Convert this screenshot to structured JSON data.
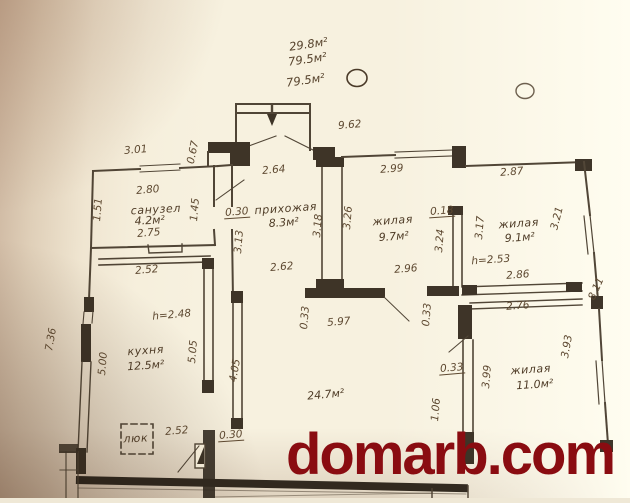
{
  "watermark": {
    "text": "domarb.com",
    "color": "#8a0c11"
  },
  "plan": {
    "ink": "#3f3324",
    "top_notes": [
      "29.8м²",
      "79.5м²",
      "79.5м²"
    ],
    "rooms": [
      {
        "name": "санузел",
        "area": "4.2м²",
        "height": ""
      },
      {
        "name": "прихожая",
        "area": "8.3м²",
        "height": ""
      },
      {
        "name": "жилая",
        "area": "9.7м²",
        "height": ""
      },
      {
        "name": "жилая",
        "area": "9.1м²",
        "height": "h=2.53"
      },
      {
        "name": "кухня",
        "area": "12.5м²",
        "height": "h=2.48"
      },
      {
        "name": "жилая",
        "area": "11.0м²",
        "height": ""
      },
      {
        "name": "люк",
        "area": "24.7м²",
        "height": ""
      }
    ],
    "labels": [
      {
        "t": "29.8м²",
        "x": 309,
        "y": 48,
        "r": -8,
        "c": "note"
      },
      {
        "t": "79.5м²",
        "x": 308,
        "y": 63,
        "r": -8,
        "c": "note"
      },
      {
        "t": "79.5м²",
        "x": 306,
        "y": 84,
        "r": -8,
        "c": "note"
      },
      {
        "t": "9.62",
        "x": 350,
        "y": 128,
        "r": -5,
        "c": "dim"
      },
      {
        "t": "3.01",
        "x": 136,
        "y": 153,
        "r": -5,
        "c": "dim"
      },
      {
        "t": "0.67",
        "x": 196,
        "y": 153,
        "r": -78,
        "c": "dim"
      },
      {
        "t": "2.80",
        "x": 148,
        "y": 193,
        "r": -5,
        "c": "dim"
      },
      {
        "t": "санузел",
        "x": 156,
        "y": 213,
        "r": -3,
        "c": "room"
      },
      {
        "t": "4.2м²",
        "x": 150,
        "y": 224,
        "r": -3,
        "c": "area"
      },
      {
        "t": "2.75",
        "x": 149,
        "y": 236,
        "r": -5,
        "c": "dim"
      },
      {
        "t": "1.51",
        "x": 101,
        "y": 210,
        "r": -85,
        "c": "dim"
      },
      {
        "t": "1.45",
        "x": 198,
        "y": 210,
        "r": -85,
        "c": "dim"
      },
      {
        "t": "0.30",
        "x": 237,
        "y": 215,
        "r": -4,
        "c": "dimu"
      },
      {
        "t": "2.64",
        "x": 274,
        "y": 173,
        "r": -5,
        "c": "dim"
      },
      {
        "t": "прихожая",
        "x": 286,
        "y": 212,
        "r": -4,
        "c": "room"
      },
      {
        "t": "8.3м²",
        "x": 284,
        "y": 226,
        "r": -4,
        "c": "area"
      },
      {
        "t": "3.13",
        "x": 242,
        "y": 242,
        "r": -85,
        "c": "dim"
      },
      {
        "t": "3.18",
        "x": 321,
        "y": 226,
        "r": -85,
        "c": "dim"
      },
      {
        "t": "2.62",
        "x": 282,
        "y": 270,
        "r": -5,
        "c": "dim"
      },
      {
        "t": "2.99",
        "x": 392,
        "y": 172,
        "r": -4,
        "c": "dim"
      },
      {
        "t": "3.26",
        "x": 351,
        "y": 218,
        "r": -85,
        "c": "dim"
      },
      {
        "t": "жилая",
        "x": 393,
        "y": 224,
        "r": -4,
        "c": "room"
      },
      {
        "t": "9.7м²",
        "x": 394,
        "y": 240,
        "r": -4,
        "c": "area"
      },
      {
        "t": "0.18",
        "x": 442,
        "y": 214,
        "r": -4,
        "c": "dimu"
      },
      {
        "t": "3.24",
        "x": 443,
        "y": 241,
        "r": -85,
        "c": "dim"
      },
      {
        "t": "2.96",
        "x": 406,
        "y": 272,
        "r": -4,
        "c": "dim"
      },
      {
        "t": "3.17",
        "x": 483,
        "y": 228,
        "r": -85,
        "c": "dim"
      },
      {
        "t": "2.87",
        "x": 512,
        "y": 175,
        "r": -4,
        "c": "dim"
      },
      {
        "t": "жилая",
        "x": 519,
        "y": 227,
        "r": -4,
        "c": "room"
      },
      {
        "t": "9.1м²",
        "x": 520,
        "y": 241,
        "r": -4,
        "c": "area"
      },
      {
        "t": "3.21",
        "x": 560,
        "y": 219,
        "r": -76,
        "c": "dim"
      },
      {
        "t": "h=2.53",
        "x": 491,
        "y": 263,
        "r": -4,
        "c": "dim"
      },
      {
        "t": "2.86",
        "x": 518,
        "y": 278,
        "r": -4,
        "c": "dim"
      },
      {
        "t": "8.11",
        "x": 599,
        "y": 290,
        "r": -66,
        "c": "dim"
      },
      {
        "t": "2.76",
        "x": 518,
        "y": 309,
        "r": -4,
        "c": "dim"
      },
      {
        "t": "0.33",
        "x": 308,
        "y": 318,
        "r": -85,
        "c": "dim"
      },
      {
        "t": "0.33",
        "x": 430,
        "y": 315,
        "r": -85,
        "c": "dim"
      },
      {
        "t": "5.97",
        "x": 339,
        "y": 325,
        "r": -4,
        "c": "dim"
      },
      {
        "t": "24.7м²",
        "x": 326,
        "y": 398,
        "r": -5,
        "c": "area"
      },
      {
        "t": "0.33",
        "x": 452,
        "y": 371,
        "r": -5,
        "c": "dimu"
      },
      {
        "t": "3.99",
        "x": 490,
        "y": 377,
        "r": -85,
        "c": "dim"
      },
      {
        "t": "жилая",
        "x": 531,
        "y": 373,
        "r": -4,
        "c": "room"
      },
      {
        "t": "11.0м²",
        "x": 535,
        "y": 388,
        "r": -4,
        "c": "area"
      },
      {
        "t": "3.93",
        "x": 570,
        "y": 347,
        "r": -80,
        "c": "dim"
      },
      {
        "t": "1.06",
        "x": 439,
        "y": 410,
        "r": -85,
        "c": "dim"
      },
      {
        "t": "2.52",
        "x": 147,
        "y": 273,
        "r": -5,
        "c": "dim"
      },
      {
        "t": "h=2.48",
        "x": 172,
        "y": 318,
        "r": -5,
        "c": "dim"
      },
      {
        "t": "кухня",
        "x": 146,
        "y": 354,
        "r": -4,
        "c": "room"
      },
      {
        "t": "12.5м²",
        "x": 146,
        "y": 369,
        "r": -4,
        "c": "area"
      },
      {
        "t": "5.00",
        "x": 106,
        "y": 364,
        "r": -85,
        "c": "dim"
      },
      {
        "t": "5.05",
        "x": 196,
        "y": 352,
        "r": -85,
        "c": "dim"
      },
      {
        "t": "4.05",
        "x": 238,
        "y": 371,
        "r": -80,
        "c": "dim"
      },
      {
        "t": "7.36",
        "x": 54,
        "y": 340,
        "r": -80,
        "c": "dim"
      },
      {
        "t": "люк",
        "x": 136,
        "y": 442,
        "r": -3,
        "c": "room"
      },
      {
        "t": "2.52",
        "x": 177,
        "y": 434,
        "r": -5,
        "c": "dim"
      },
      {
        "t": "0.30",
        "x": 231,
        "y": 438,
        "r": -4,
        "c": "dimu"
      }
    ]
  }
}
